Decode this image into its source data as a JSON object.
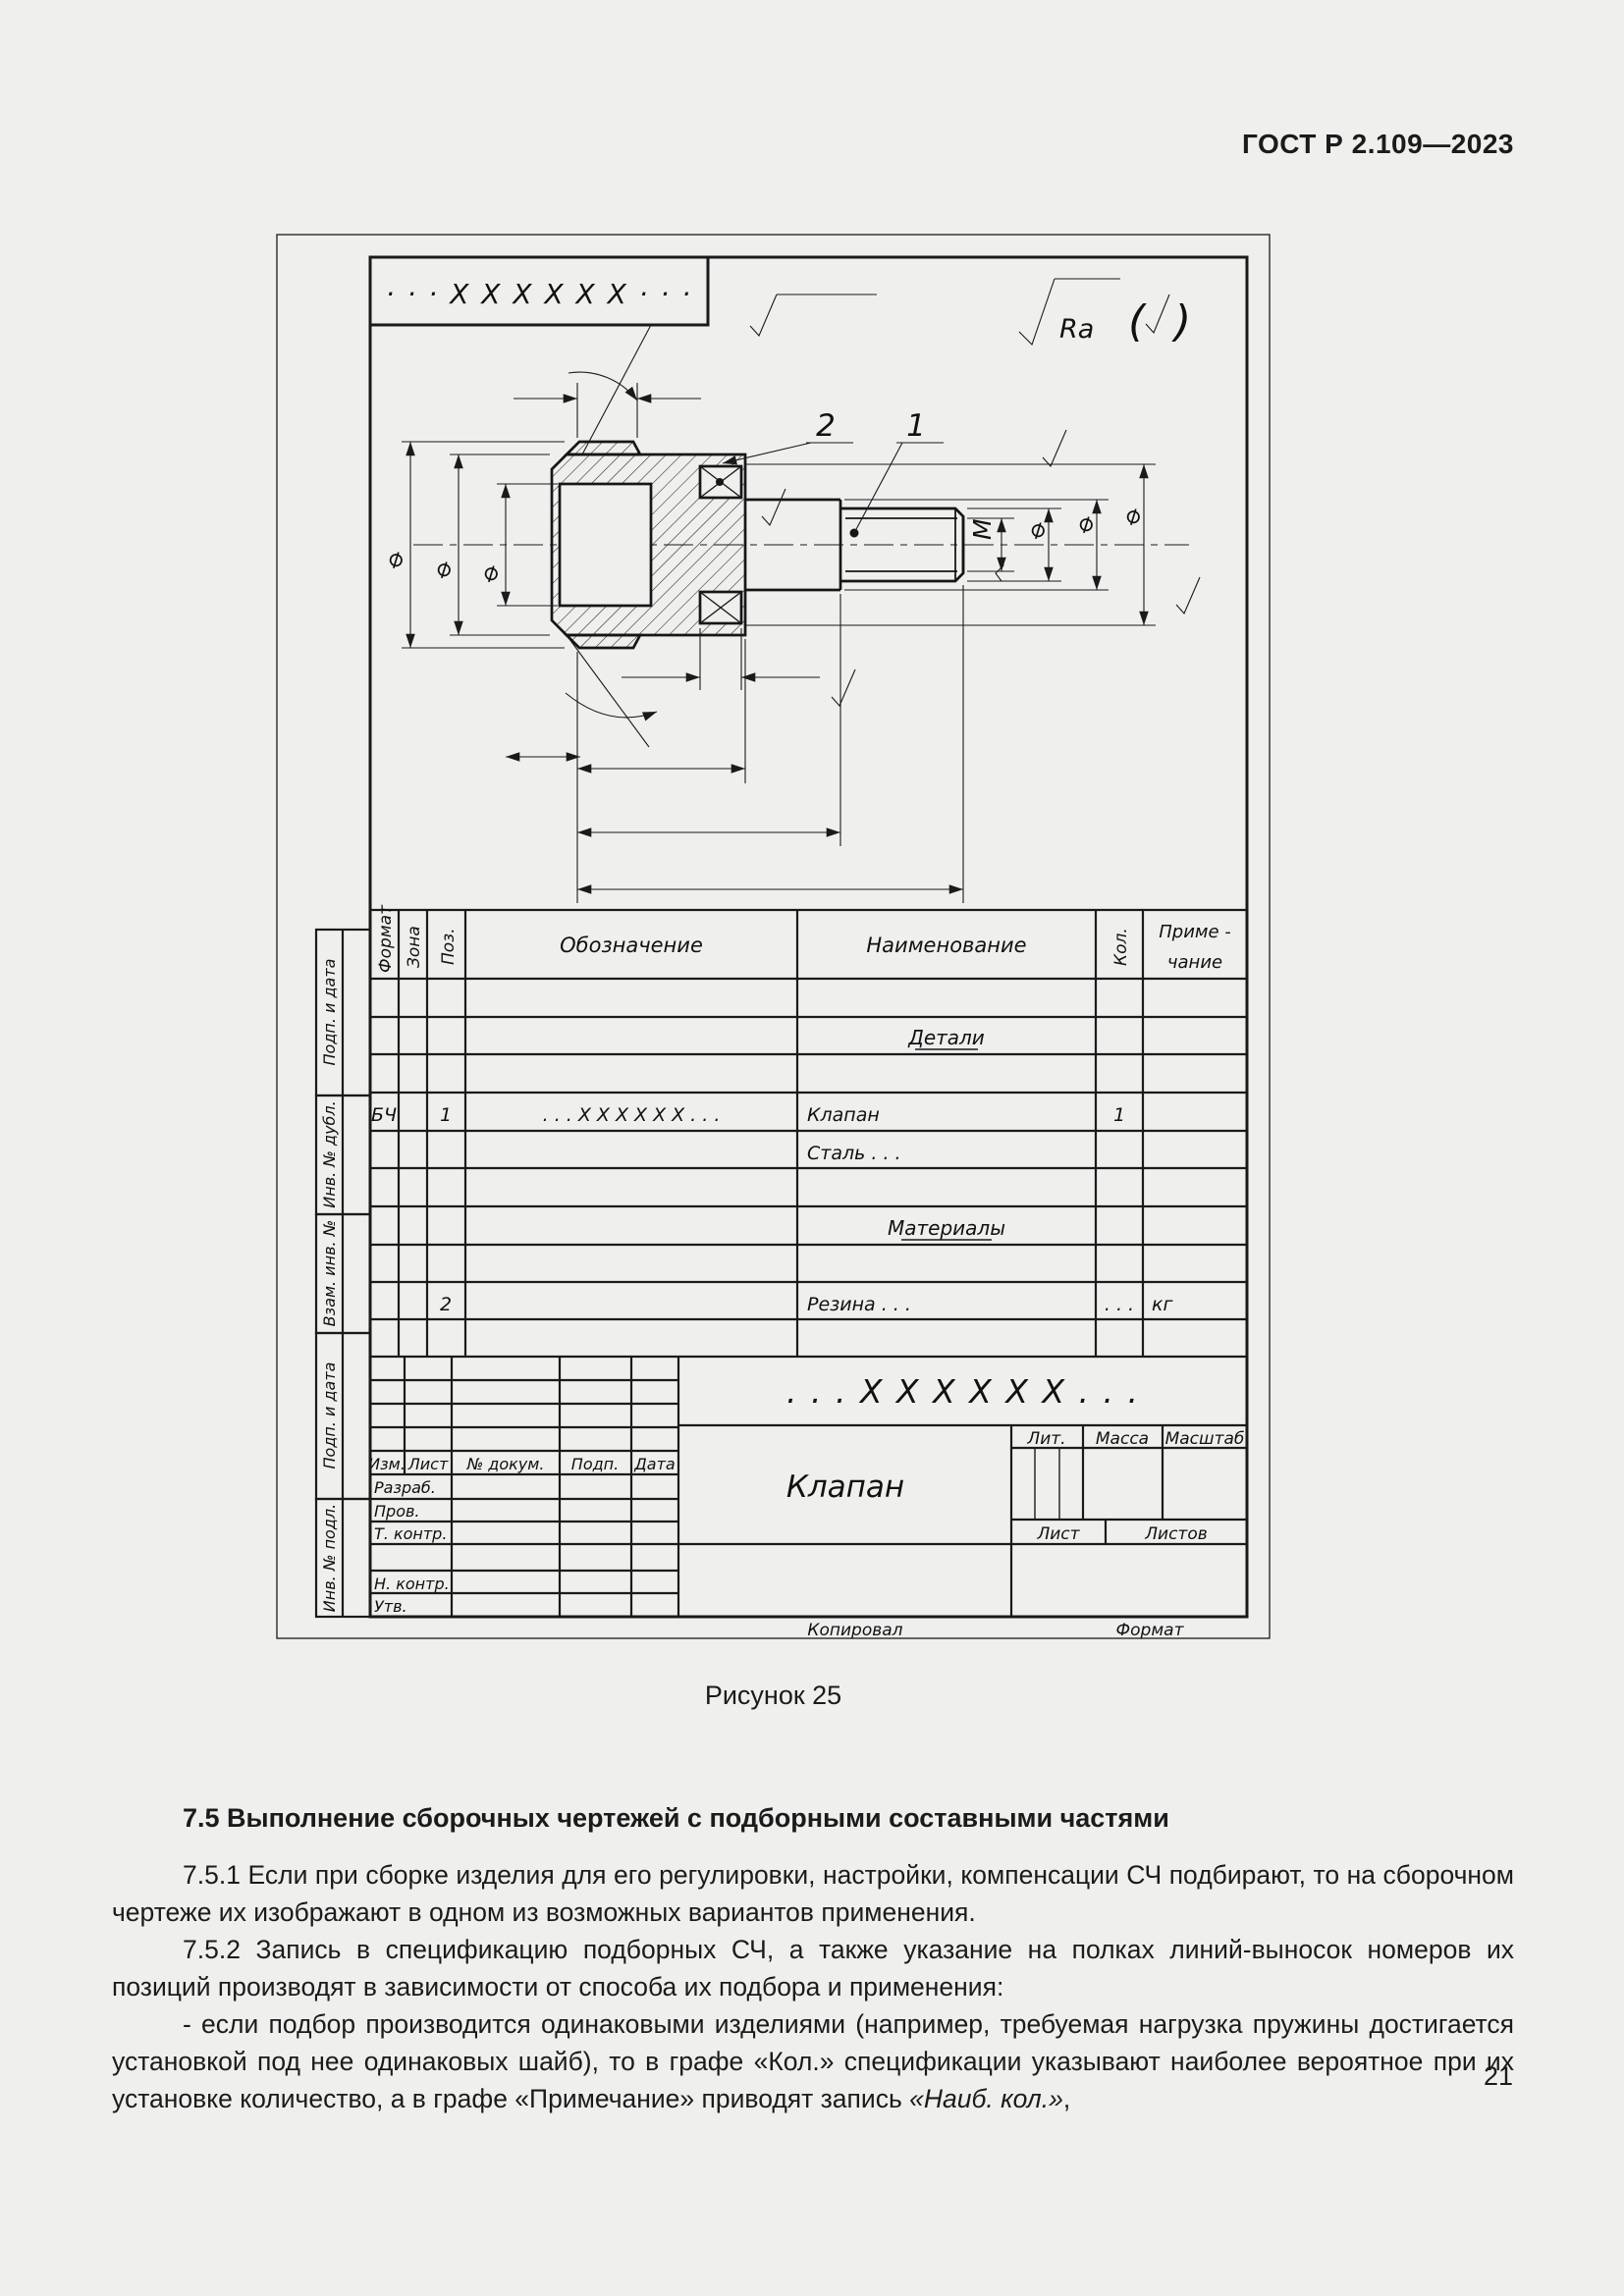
{
  "page": {
    "header": "ГОСТ Р 2.109—2023",
    "figure_caption": "Рисунок 25",
    "page_number": "21"
  },
  "figure": {
    "stamp_top": "· · ·  X X X X X X  · · ·",
    "roughness": {
      "ra_label": "Ra",
      "paren_left": "(",
      "paren_right": ")"
    },
    "callouts": {
      "item1": "1",
      "item2": "2"
    },
    "symbols": {
      "dia": "⌀",
      "thread": "M"
    },
    "spec_table": {
      "headers": {
        "format": "Формат",
        "zone": "Зона",
        "pos": "Поз.",
        "designation": "Обозначение",
        "name": "Наименование",
        "qty": "Кол.",
        "note_line1": "Приме -",
        "note_line2": "чание"
      },
      "section_details": "Детали",
      "item1": {
        "format": "БЧ",
        "pos": "1",
        "designation": ". . . X X X X X X . . .",
        "name": "Клапан",
        "qty": "1"
      },
      "item1_material": "Сталь . . .",
      "section_materials": "Материалы",
      "item2": {
        "pos": "2",
        "name": "Резина . . .",
        "qty": ". . .",
        "note": "кг"
      }
    },
    "title_block": {
      "designation": ". . . X X X X X X . . .",
      "product_name": "Клапан",
      "izm": "Изм.",
      "list_col": "Лист",
      "doc": "№ докум.",
      "podp": "Подп.",
      "data": "Дата",
      "razrab": "Разраб.",
      "prov": "Пров.",
      "tkontr": "Т. контр.",
      "nkontr": "Н. контр.",
      "utv": "Утв.",
      "lit": "Лит.",
      "massa": "Масса",
      "masshtab": "Масштаб",
      "list": "Лист",
      "listov": "Листов",
      "kopiroval": "Копировал",
      "format": "Формат"
    },
    "sidebar": [
      "Подп. и дата",
      "Инв. № дубл.",
      "Взам. инв. №",
      "Подп. и дата",
      "Инв. № подл."
    ]
  },
  "content": {
    "heading": "7.5 Выполнение сборочных чертежей с подборными составными частями",
    "p751": "7.5.1 Если при сборке изделия для его регулировки, настройки, компенсации СЧ подбирают, то на сборочном чертеже их изображают в одном из возможных вариантов применения.",
    "p752": "7.5.2 Запись в спецификацию подборных СЧ, а также указание на полках линий-выносок номеров их позиций производят в зависимости от способа их подбора и применения:",
    "li1_text": "- если подбор производится одинаковыми изделиями (например, требуемая нагрузка пружины достигается установкой под нее одинаковых шайб), то в графе «Кол.» спецификации указывают наиболее вероятное при их установке количество, а в графе «Примечание» приводят запись ",
    "li1_italic": "«Наиб. кол.»",
    "li1_tail": ","
  }
}
